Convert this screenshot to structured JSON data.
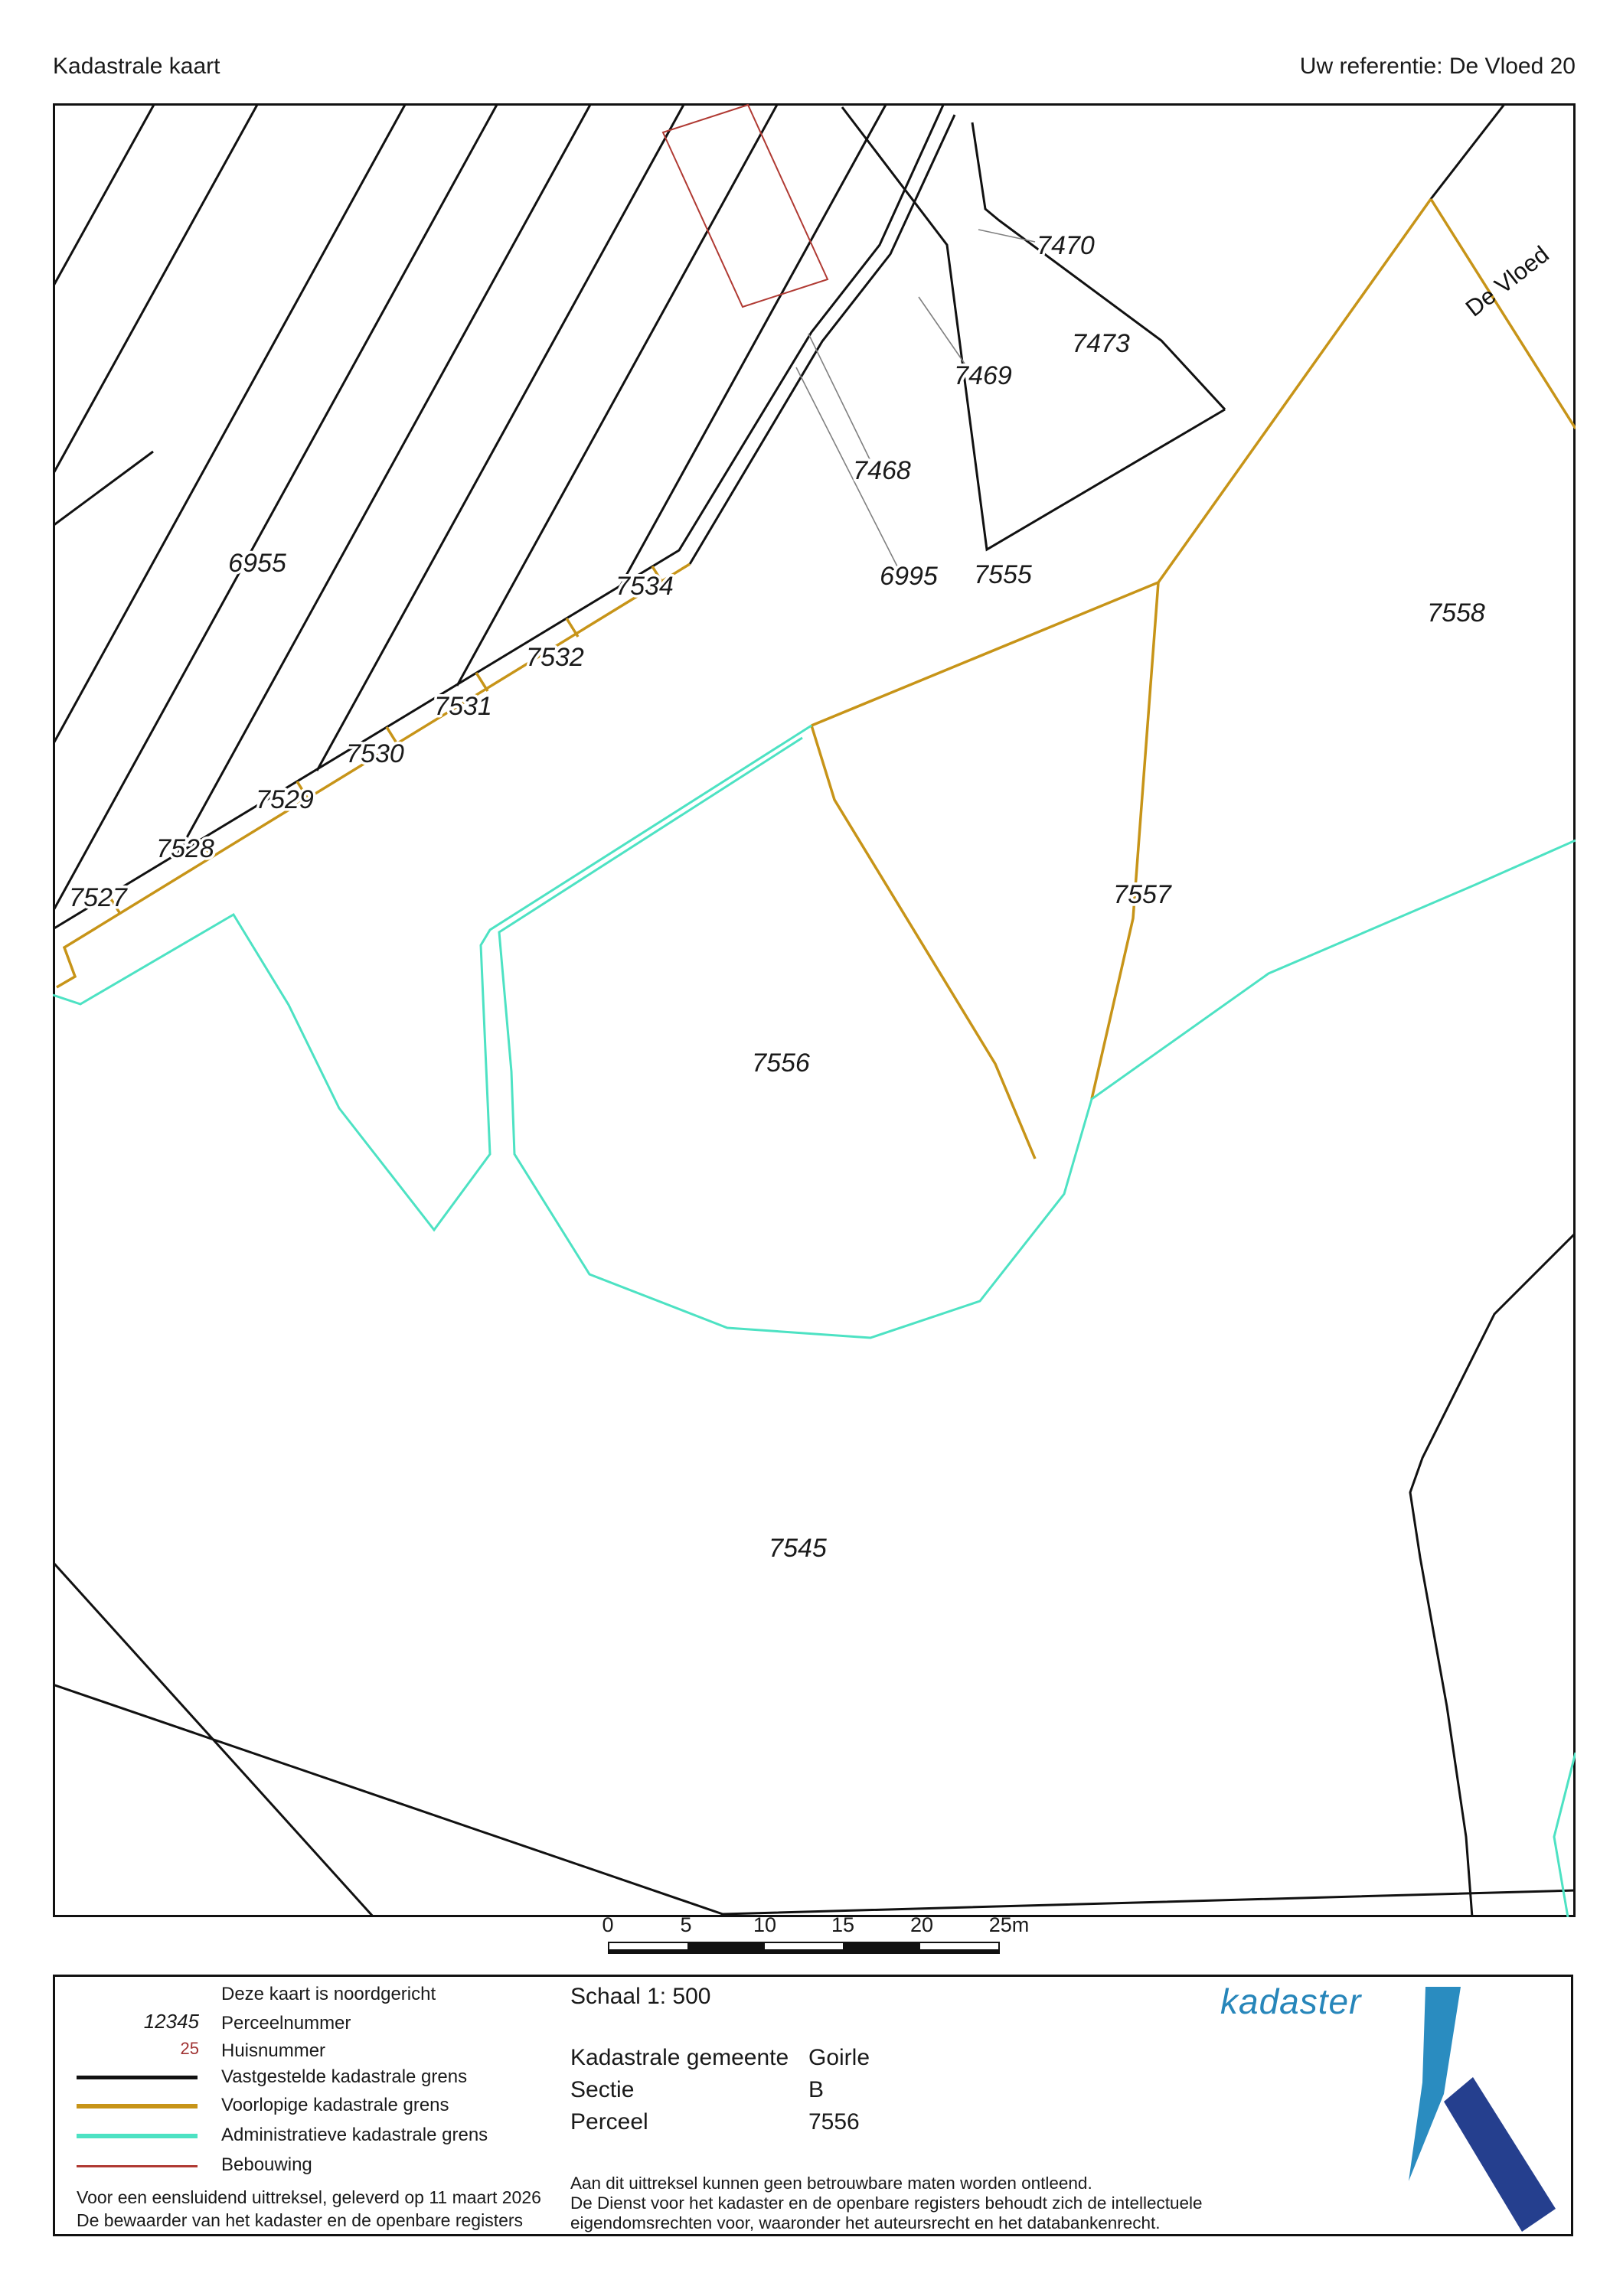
{
  "header": {
    "title": "Kadastrale kaart",
    "reference": "Uw referentie: De Vloed 20"
  },
  "map": {
    "street": "De Vloed",
    "labels": [
      "6955",
      "7534",
      "7532",
      "7531",
      "7530",
      "7529",
      "7528",
      "7527",
      "6995",
      "7555",
      "7558",
      "7557",
      "7556",
      "7545",
      "7470",
      "7473",
      "7469",
      "7468"
    ]
  },
  "scalebar": {
    "ticks": [
      "0",
      "5",
      "10",
      "15",
      "20",
      "25m"
    ]
  },
  "legend": {
    "north_note": "Deze kaart is noordgericht",
    "parcel_sample": "12345",
    "parcel_label": "Perceelnummer",
    "house_sample": "25",
    "house_label": "Huisnummer",
    "established": "Vastgestelde kadastrale grens",
    "provisional": "Voorlopige kadastrale grens",
    "administrative": "Administratieve kadastrale grens",
    "building": "Bebouwing",
    "issued_line1": "Voor een eensluidend uittreksel, geleverd op 11 maart 2026",
    "issued_line2": "De bewaarder van het kadaster en de openbare registers"
  },
  "info": {
    "scale": "Schaal 1: 500",
    "municipality_label": "Kadastrale gemeente",
    "municipality": "Goirle",
    "section_label": "Sectie",
    "section": "B",
    "parcel_label": "Perceel",
    "parcel": "7556",
    "disclaimer1": "Aan dit uittreksel kunnen geen betrouwbare maten worden ontleend.",
    "disclaimer2": "De Dienst voor het kadaster en de openbare registers behoudt zich de intellectuele",
    "disclaimer3": "eigendomsrechten voor, waaronder het auteursrecht en het databankenrecht."
  },
  "logo": {
    "text": "kadaster"
  },
  "colors": {
    "established_boundary": "#111111",
    "provisional_boundary": "#c79418",
    "administrative_boundary": "#4de2c3",
    "building_outline": "#b03a33",
    "house_number": "#a03333",
    "logo_text": "#2786ba",
    "logo_light": "#2a8cc0",
    "logo_dark": "#253f8e"
  }
}
